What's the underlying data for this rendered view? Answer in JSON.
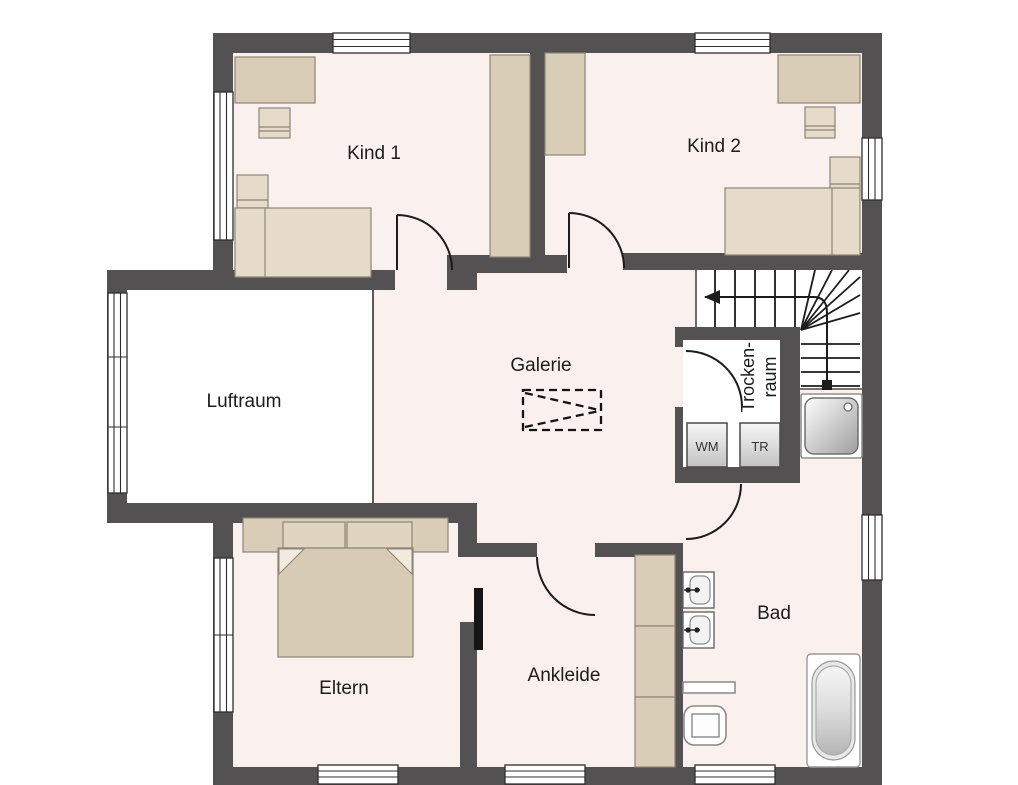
{
  "title": "Obergeschoss Grundriss",
  "colors": {
    "wall": "#545152",
    "floor": "#faf0ee",
    "void_floor": "#ffffff",
    "furniture": "#d9cdb7",
    "furniture_light": "#e5dbc8",
    "bed_mattress": "#d8cbb3",
    "line": "#1c1c1c"
  },
  "rooms": {
    "kind1": "Kind 1",
    "kind2": "Kind 2",
    "luftraum": "Luftraum",
    "galerie": "Galerie",
    "trockenraum_line1": "Trocken-",
    "trockenraum_line2": "raum",
    "eltern": "Eltern",
    "ankleide": "Ankleide",
    "bad": "Bad"
  },
  "appliances": {
    "wm": "WM",
    "tr": "TR"
  }
}
